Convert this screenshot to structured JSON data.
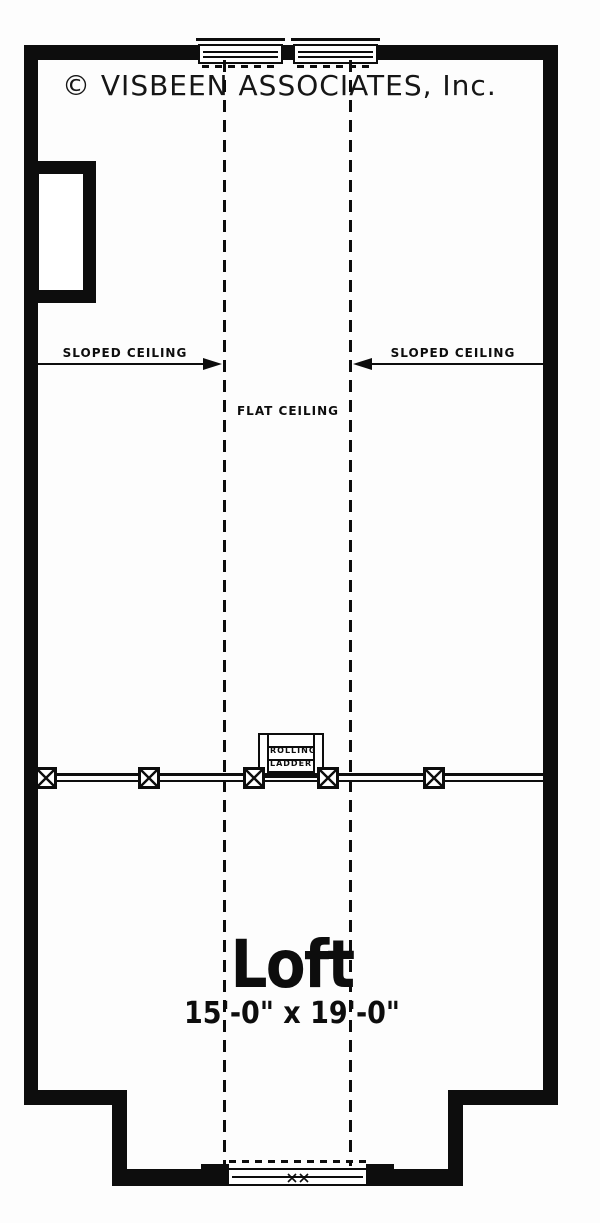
{
  "copyright": "© VISBEEN ASSOCIATES, Inc.",
  "ceiling": {
    "sloped_left_label": "SLOPED CEILING",
    "sloped_right_label": "SLOPED CEILING",
    "flat_label": "FLAT CEILING"
  },
  "ladder": {
    "label_line1": "ROLLING",
    "label_line2": "LADDER"
  },
  "room": {
    "name": "Loft",
    "dimensions": "15'-0\" x 19'-0\""
  },
  "icons": {
    "arrowhead_right": "right-arrowhead",
    "arrowhead_left": "left-arrowhead",
    "railing_post": "x-in-box",
    "window_mark": "x-mark"
  },
  "colors": {
    "ink": "#0d0d0d",
    "paper": "#fdfdfd"
  }
}
